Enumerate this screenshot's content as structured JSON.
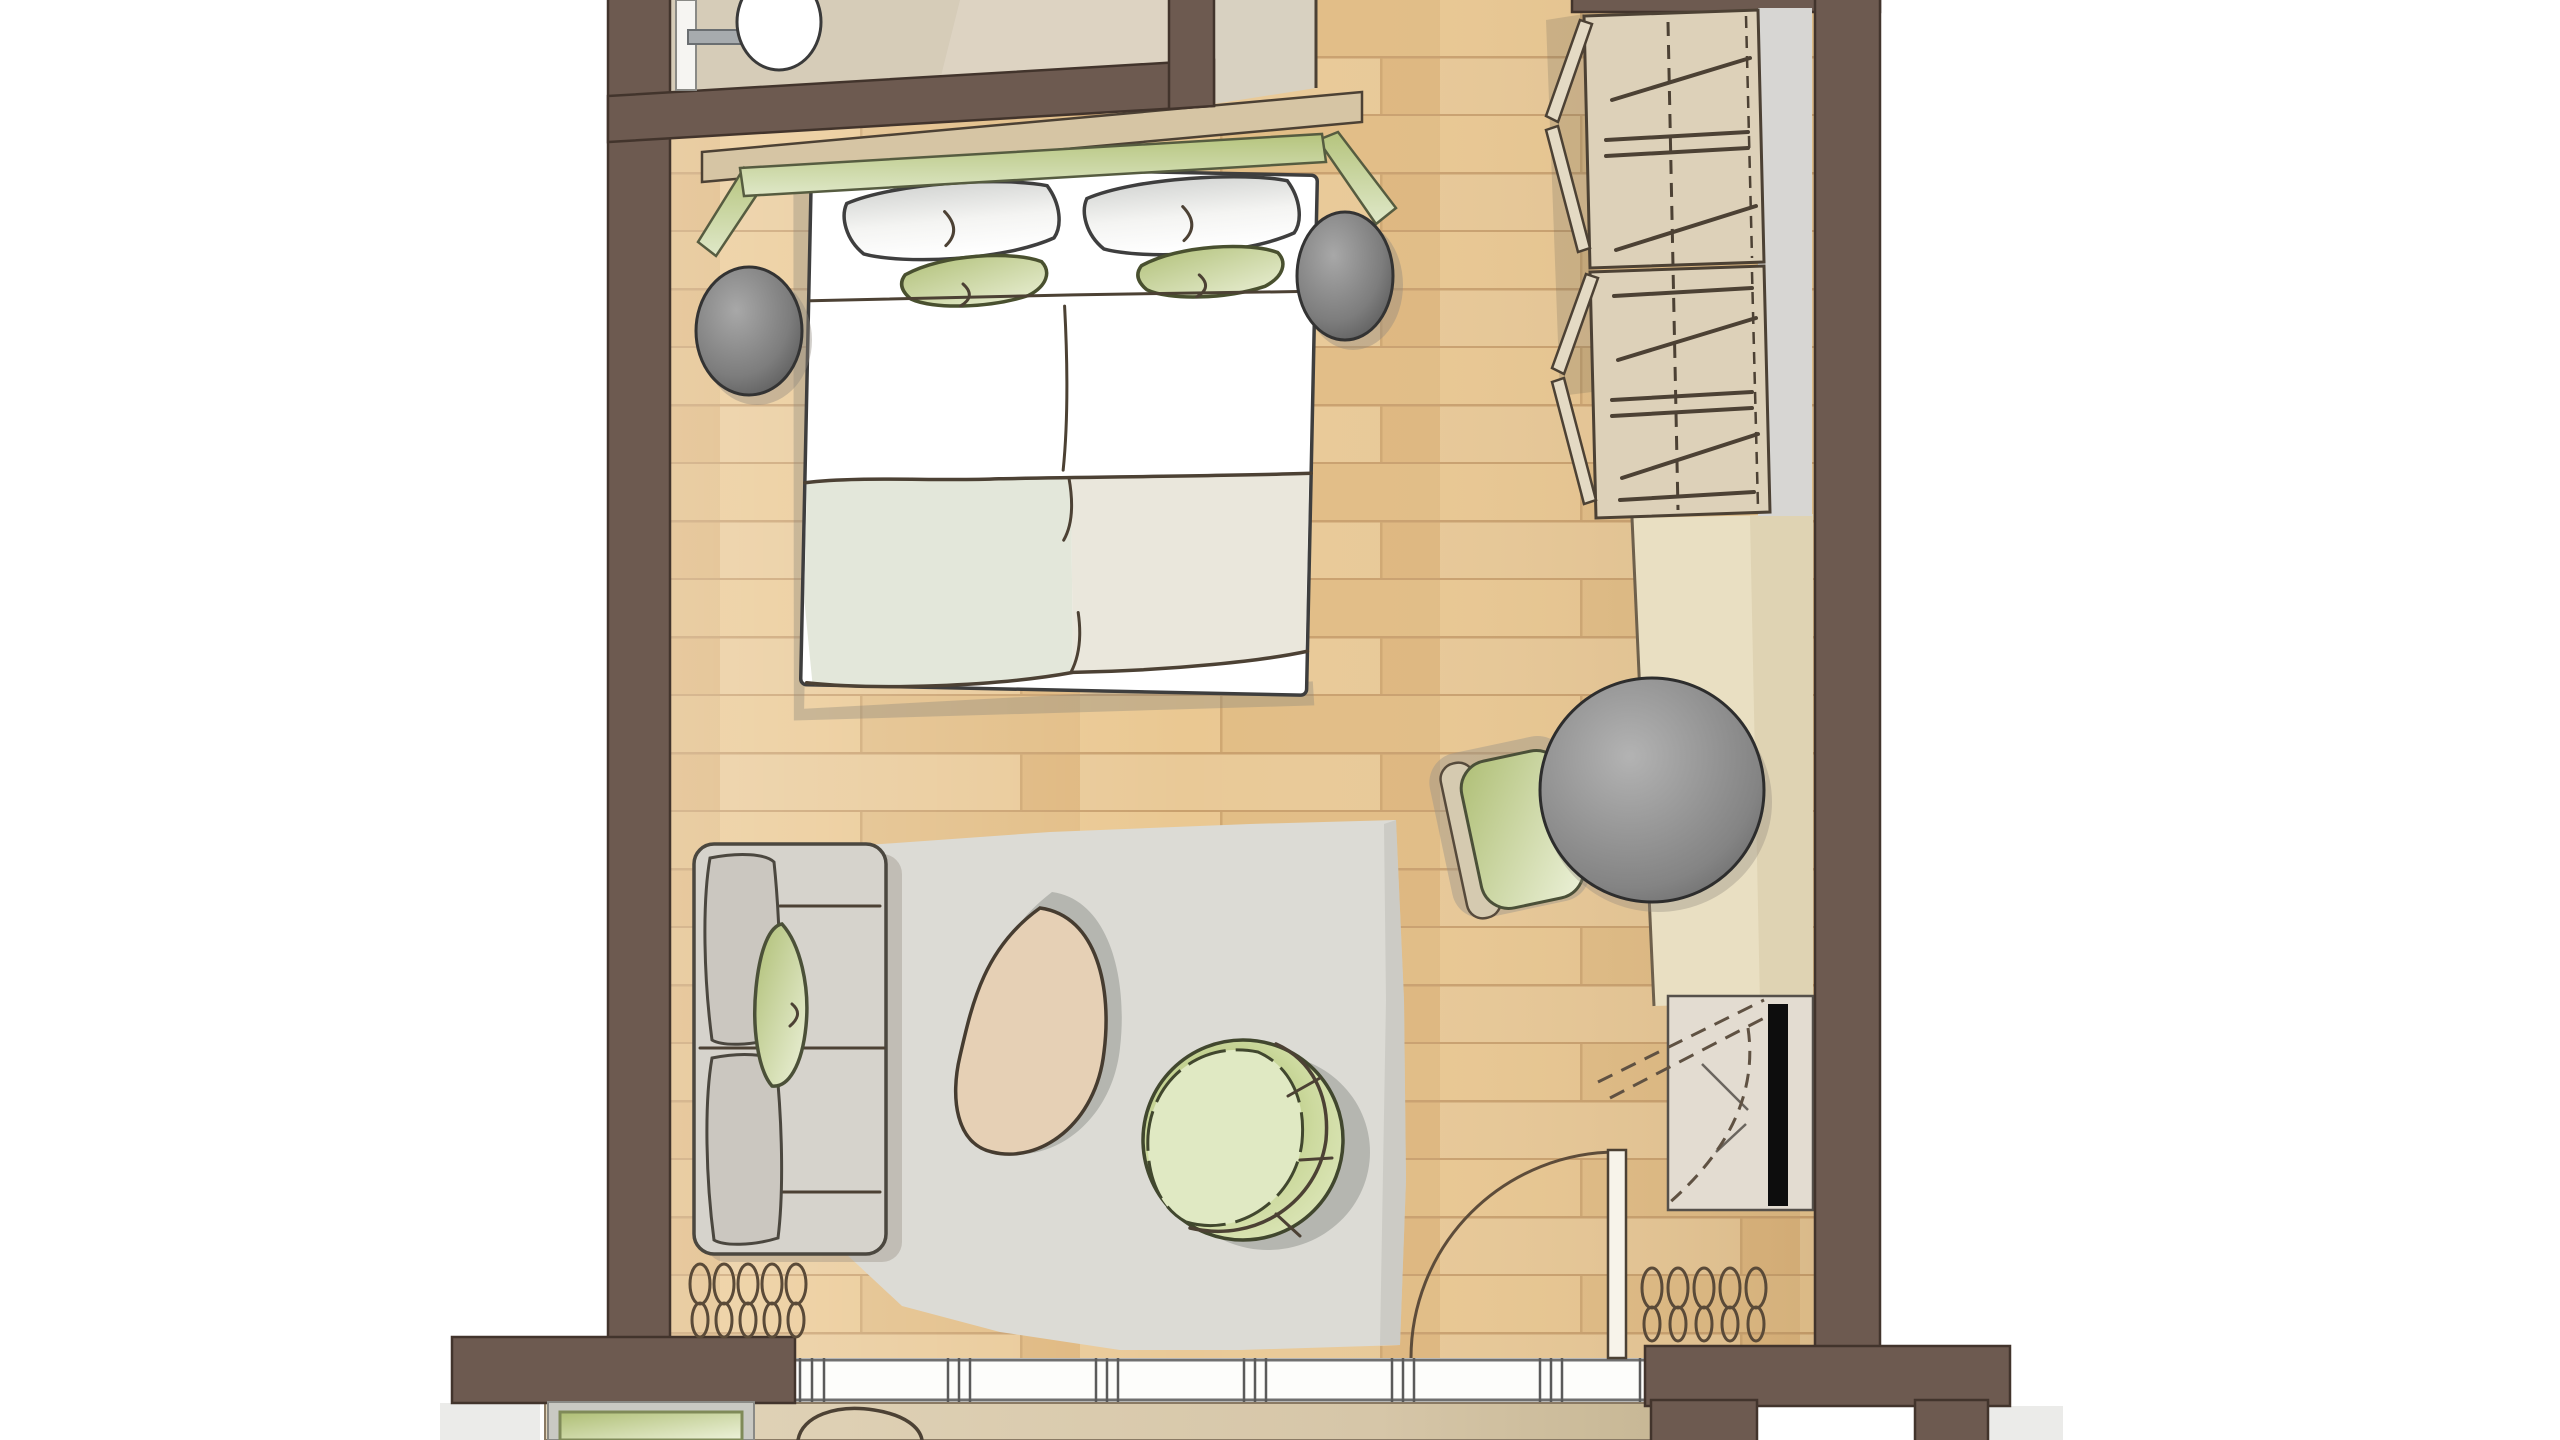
{
  "title": "Hotel room floor plan (top-down architectural rendering, no visible text)",
  "palette": {
    "wall": "#6d5a50",
    "wall-line": "#42342c",
    "ink": "#4c4134",
    "wood": "#e7c593",
    "wood-line": "#c9a06d",
    "bath-floor": "#ddd3c2",
    "niche-floor": "#d8d1c1",
    "rug": "#dcdbd5",
    "sideboard": "#e9dfc2",
    "wardrobe-door": "#ddd1b9",
    "wardrobe-back": "#d7d6d3",
    "shelf-tan": "#d6c5a4",
    "green-dark": "#b5c47d",
    "green-light": "#e9efd4",
    "sofa-gray": "#d6d3cc",
    "cushion-gray": "#cbc7c0",
    "stool-gray": "#6e6e6e",
    "table-gray": "#7c7c7c",
    "pouf-beige": "#e6d0b5",
    "blanket-left": "#e3e7da",
    "blanket-right": "#eae7dc",
    "tv-black": "#0d0d0d",
    "window-white": "#fdfdfb",
    "balcony-floor": "#decfb4"
  },
  "rooms": {
    "bedroom": "bedroom with wood plank flooring",
    "bathroom": "bathroom (top left, partially cut off)",
    "closet_niche": "niche beside bathroom",
    "balcony": "balcony strip below window wall (partially cut off)"
  },
  "furniture": {
    "bed": "double bed with two white pillows and two green pillows",
    "headboard": "green headboard with angled side wings",
    "shelf": "wall shelf behind headboard",
    "stool_left": "round gray bedside stool left",
    "stool_right": "round gray bedside stool right",
    "wardrobe": "double wardrobe with bifold doors and clothes hangers",
    "sideboard": "long sideboard / desk along right wall",
    "table": "round gray table",
    "desk_chair": "green chair tucked under table",
    "tv": "wall-mounted TV with swivel arc",
    "tv_console": "TV console cabinet",
    "sofa": "two-seat sofa against left wall",
    "sofa_pillow": "green accent pillow on sofa",
    "rug": "large gray area rug",
    "pouf": "teardrop shaped beige pouf",
    "tub_chair": "round green tub chair",
    "balcony_door": "balcony door with 90-degree swing arc",
    "curtain_left": "curtain coil symbol left of window",
    "curtain_right": "curtain coil symbol right of window",
    "window": "window band with mullions along bottom wall",
    "planter": "green planter box on balcony",
    "balcony_chair": "balcony chair (partially cut off)",
    "sink": "bathroom washbasin with faucet (partially cut off)"
  }
}
